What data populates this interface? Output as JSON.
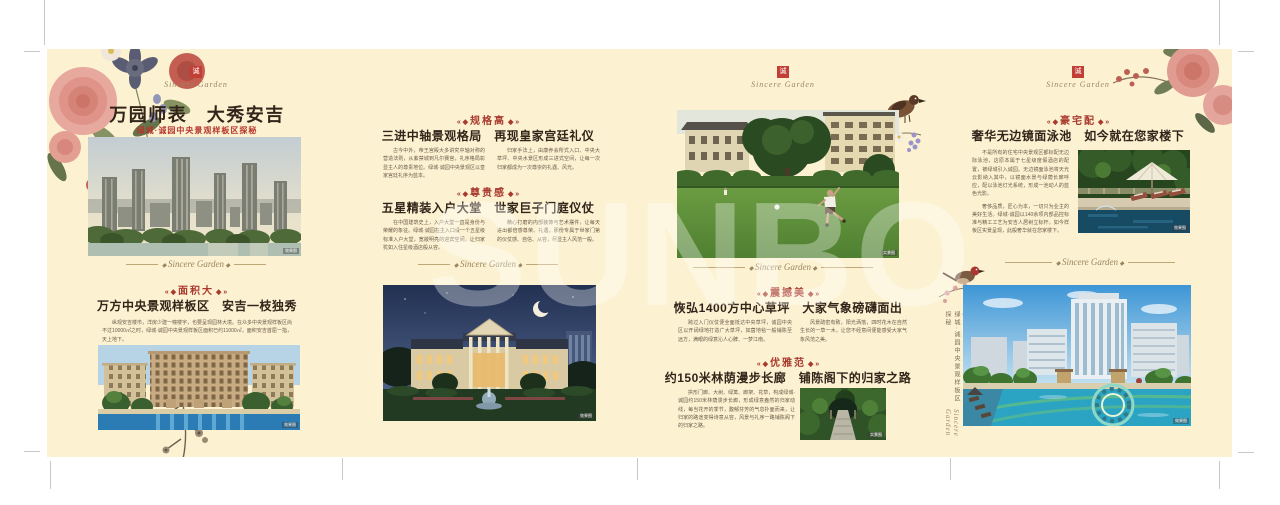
{
  "brand": {
    "seal_char": "诚",
    "script": "Sincere Garden"
  },
  "watermark": "SUNBO",
  "panel1": {
    "title": "万园师表　大秀安吉",
    "subtitle": "绿城·诚园中央景观样板区探秘",
    "badge": "面积大",
    "headline": "万方中央景观样板区　安吉一枝独秀",
    "body": "纵观安吉楼市，洋房少建一幢楼宇，也要呈现园林大境。在众多中央景观样板区尚不过10000㎡之时，绿城·诚园中央景观样板区面积已约11000㎡，面积安吉首屈一指，天上地下。",
    "photo1_caption": "效果图",
    "photo2_caption": "效果图"
  },
  "panel2": {
    "sections": [
      {
        "badge": "规格高",
        "headline": "三进中轴景观格局　再现皇家宫廷礼仪",
        "col1": "古今中外，帝王宫殿大多讲究中轴对称的营造法则，从紫禁城到凡尔赛宫，礼序格局彰显主人的尊贵地位。绿城·诚园中央景观区以皇家宫廷礼序为蓝本。",
        "col2": "归家手法上，由康养会所式入口、中央大草坪、中央水景区形成三进式空间，让每一次归家都成为一次尊崇的礼遇、风光。"
      },
      {
        "badge": "尊贵感",
        "headline": "五星精装入户大堂　世家巨子门庭仪仗",
        "col1": "在中国建筑史上，入户大堂一直是身份与荣耀的象征。绿城·诚园在主入口设一个五星级标准入户大堂，宽敞明亮的迎宾空间，让归家犹如入住星级酒店般从容。",
        "col2": "精心打磨的内部装饰与艺术摆件，让每天进出都倍感尊荣、礼遇，那份专属于世家门第的仪仗感、自信、从容，尽显主人风范一般。"
      }
    ],
    "photo_caption": "效果图"
  },
  "panel3": {
    "sections": [
      {
        "badge": "震撼美",
        "headline": "恢弘1400方中心草坪　大家气象磅礴面出",
        "col1": "跨过入门仪仗便全面抵达中央草坪，诚园中央区以开阔绿地打造广大草坪，如茵地毯一般铺陈至远方，满眼的绿意沁人心脾、一梦江南。",
        "col2": "风景疏密有致，阳光洒落，四时花木在自然生长的一草一木，让您不经意间便能感受大家气象风范之美。"
      },
      {
        "badge": "优雅范",
        "headline": "约150米林荫漫步长廊　铺陈阁下的归家之路",
        "col1": "拱形门廊、大树、绿篱、廊架、花草，构成绿城·诚园约150米林荫漫步长廊，形成绿意盎然的归家动线，每当花开的季节，馥郁芬芳的气息扑面而来，让归家的路途变得诗意从容，风景与礼序一路铺陈阁下的归家之路。"
      }
    ],
    "photo1_caption": "实景图",
    "photo2_caption": "实景图"
  },
  "panel4": {
    "badge": "豪宅配",
    "headline": "奢华无边镜面泳池　如今就在您家楼下",
    "para1": "不是所有的住宅中央景观区都标配无边际泳池，这原本属于七星级度假酒店的配置，被绿城引入诚园。无边镜面泳池将天光云影纳入其中，以镜面水景与绿荫长廊呼应，配以泳池灯光系统，形成一池动人的蓝色光影。",
    "para2": "奢侈品质，匠心为本，一切只为业主的美好生活。绿城·诚园以140余项内部品控标准与精工工艺为安吉人居树立标杆。如今样板区实景呈现，此般奢华就在您家楼下。",
    "photo1_caption": "效果图",
    "photo2_caption": "效果图",
    "side_caption": "绿城·诚园中央景观样板区探秘"
  }
}
